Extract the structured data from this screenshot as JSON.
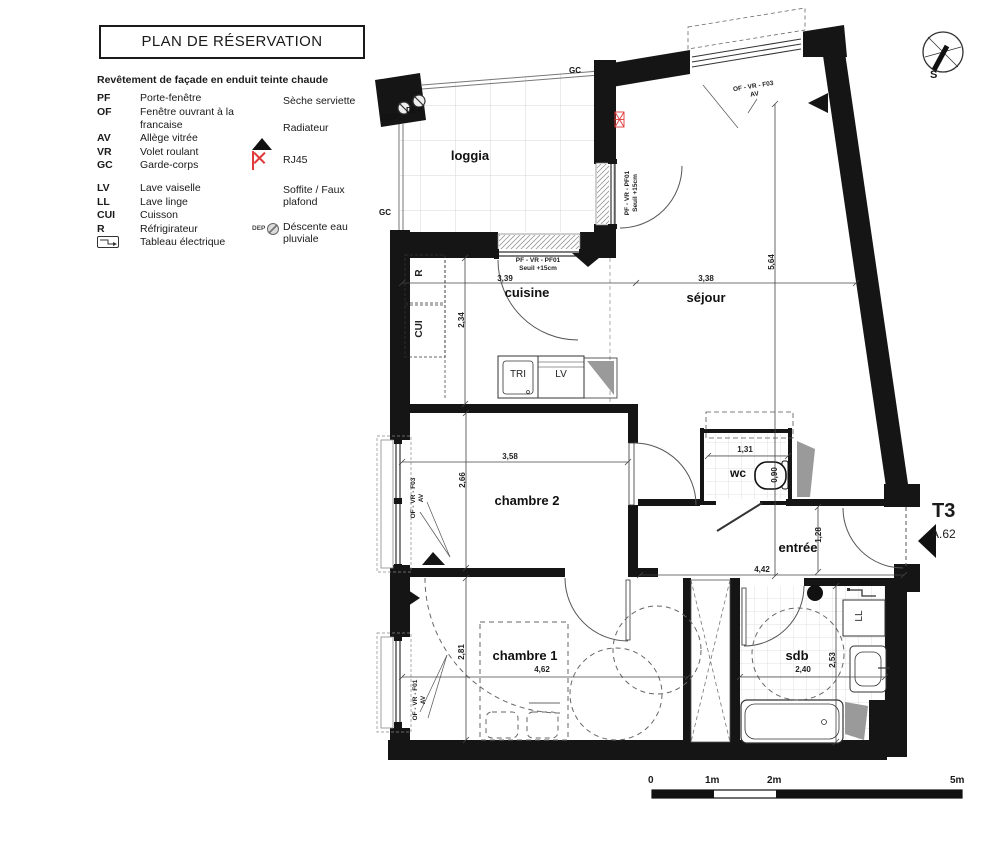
{
  "header": {
    "title": "PLAN DE RÉSERVATION",
    "facade_note": "Revêtement de façade en enduit teinte chaude"
  },
  "legend": {
    "abbreviations": [
      {
        "abbr": "PF",
        "label": "Porte-fenêtre"
      },
      {
        "abbr": "OF",
        "label": "Fenêtre ouvrant à la francaise"
      },
      {
        "abbr": "AV",
        "label": "Allège vitrée"
      },
      {
        "abbr": "VR",
        "label": "Volet roulant"
      },
      {
        "abbr": "GC",
        "label": "Garde-corps"
      },
      {
        "abbr": "LV",
        "label": "Lave vaiselle"
      },
      {
        "abbr": "LL",
        "label": "Lave linge"
      },
      {
        "abbr": "CUI",
        "label": "Cuisson"
      },
      {
        "abbr": "R",
        "label": "Réfrigirateur"
      },
      {
        "abbr": "",
        "label": "Tableau électrique"
      }
    ],
    "symbols": [
      {
        "icon": "black-circle",
        "label": "Sèche serviette"
      },
      {
        "icon": "black-triangle",
        "label": "Radiateur"
      },
      {
        "icon": "red-x-box",
        "label": "RJ45"
      },
      {
        "icon": "dot-pattern",
        "label": "Soffite / Faux plafond"
      },
      {
        "icon": "dep-circle",
        "label": "Déscente eau pluviale",
        "prefix": "DEP"
      }
    ]
  },
  "plan": {
    "rooms": {
      "loggia": "loggia",
      "cuisine": "cuisine",
      "sejour": "séjour",
      "chambre2": "chambre 2",
      "chambre1": "chambre 1",
      "wc": "wc",
      "entree": "entrée",
      "sdb": "sdb"
    },
    "annotations": {
      "gc_top": "GC",
      "gc_bottom": "GC",
      "dep1": "DEP",
      "dep2": "DEP",
      "r": "R",
      "cui": "CUI",
      "tri": "TRI",
      "lv": "LV",
      "ll": "LL"
    },
    "windows": {
      "cuisine_l1": "PF - VR - PF01",
      "cuisine_l2": "Seuil +15cm",
      "loggia_l1": "PF - VR - PF01",
      "loggia_l2": "Seuil +15cm",
      "sejour_l1": "OF - VR - F03",
      "sejour_l2": "AV",
      "ch2_l1": "OF - VR - F03",
      "ch2_l2": "AV",
      "ch1_l1": "OF - VR - F01",
      "ch1_l2": "AV"
    },
    "dimensions": {
      "cuisine_w": "3,39",
      "cuisine_h": "2,34",
      "sejour_w": "3,38",
      "sejour_h": "5,64",
      "ch2_w": "3,58",
      "ch2_h": "2,66",
      "wc_w": "1,31",
      "wc_d": "0,90",
      "entree_w": "4,42",
      "entree_h": "1,28",
      "ch1_w": "4,62",
      "ch1_h": "2,81",
      "sdb_w": "2,40",
      "sdb_h": "2,53"
    }
  },
  "unit": {
    "type": "T3",
    "number": "A.62"
  },
  "compass": {
    "label": "S"
  },
  "scale_bar": {
    "labels": [
      "0",
      "1m",
      "2m",
      "5m"
    ]
  },
  "colors": {
    "wall": "#151515",
    "accent_red": "#e03a3a",
    "tile_line": "#d6d6d6",
    "dim_line": "#444444"
  }
}
